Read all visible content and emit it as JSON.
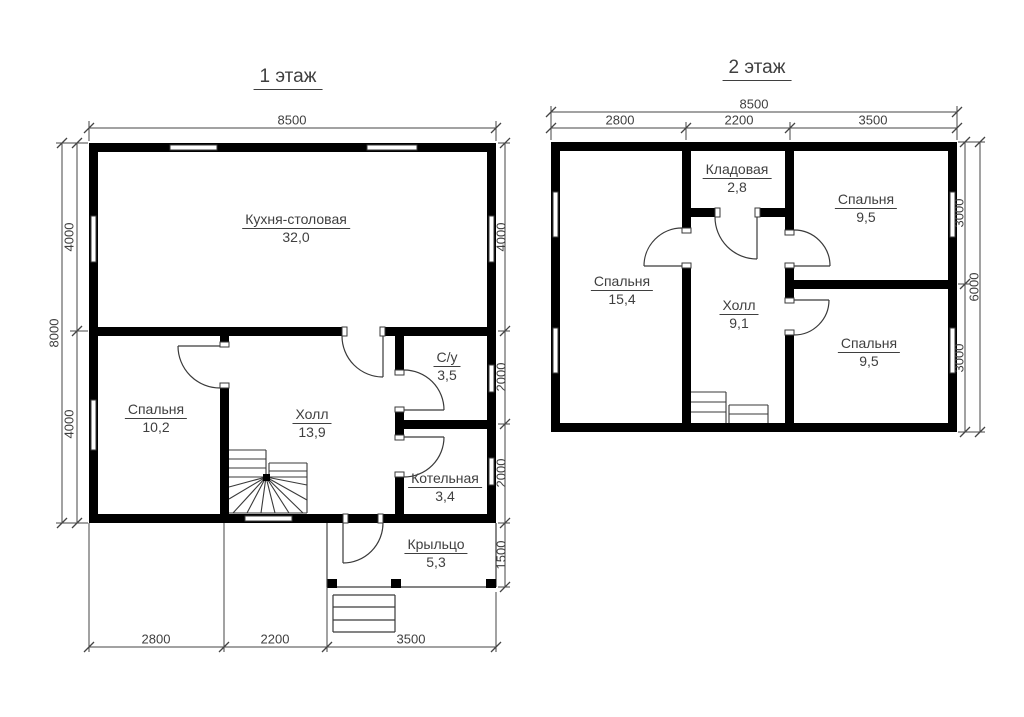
{
  "floor1": {
    "title": "1 этаж",
    "rooms": {
      "kitchen": {
        "name": "Кухня-столовая",
        "area": "32,0"
      },
      "bedroom": {
        "name": "Спальня",
        "area": "10,2"
      },
      "hall": {
        "name": "Холл",
        "area": "13,9"
      },
      "bathroom": {
        "name": "С/у",
        "area": "3,5"
      },
      "boiler": {
        "name": "Котельная",
        "area": "3,4"
      },
      "porch": {
        "name": "Крыльцо",
        "area": "5,3"
      }
    },
    "dimensions": {
      "top_total": "8500",
      "left_total": "8000",
      "left": [
        "4000",
        "4000"
      ],
      "right": [
        "4000",
        "2000",
        "2000",
        "1500"
      ],
      "bottom": [
        "2800",
        "2200",
        "3500"
      ]
    }
  },
  "floor2": {
    "title": "2 этаж",
    "rooms": {
      "bedroom_large": {
        "name": "Спальня",
        "area": "15,4"
      },
      "storage": {
        "name": "Кладовая",
        "area": "2,8"
      },
      "hall": {
        "name": "Холл",
        "area": "9,1"
      },
      "bedroom_top": {
        "name": "Спальня",
        "area": "9,5"
      },
      "bedroom_bottom": {
        "name": "Спальня",
        "area": "9,5"
      }
    },
    "dimensions": {
      "top_total": "8500",
      "top": [
        "2800",
        "2200",
        "3500"
      ],
      "right": [
        "3000",
        "3000"
      ],
      "right_total": "6000"
    }
  },
  "colors": {
    "wall": "#000000",
    "thin_line": "#3a3a3a",
    "dimension_line": "#444444",
    "text": "#3f3f3f",
    "background": "#ffffff"
  }
}
